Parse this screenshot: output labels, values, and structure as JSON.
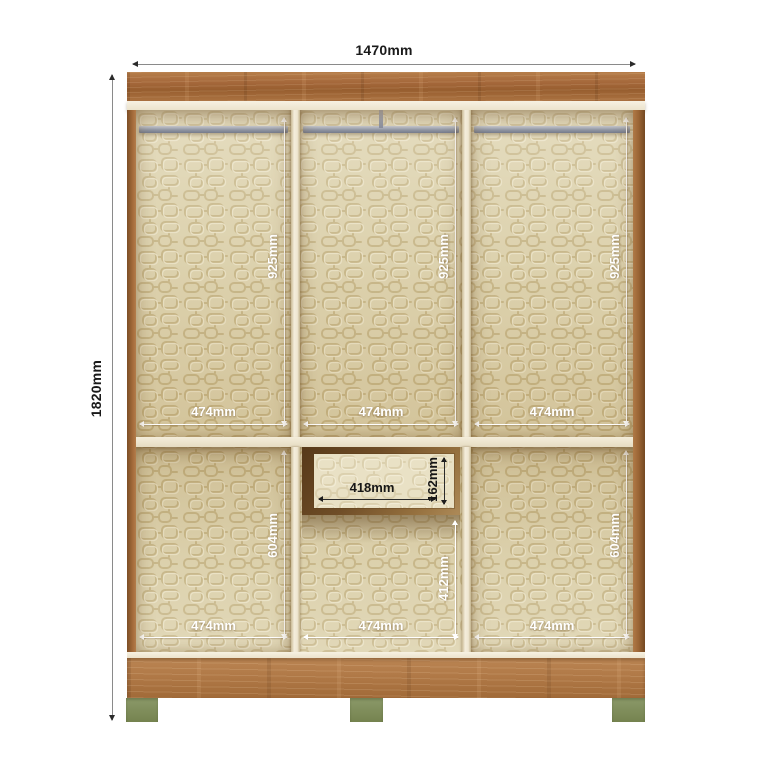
{
  "wardrobe": {
    "overall": {
      "width": "1470mm",
      "height": "1820mm"
    },
    "upper_sections": [
      {
        "width": "474mm",
        "height": "925mm"
      },
      {
        "width": "474mm",
        "height": "925mm"
      },
      {
        "width": "474mm",
        "height": "925mm"
      }
    ],
    "lower_sections": [
      {
        "width": "474mm",
        "height": "604mm"
      },
      {
        "width": "474mm",
        "height": "412mm"
      },
      {
        "width": "474mm",
        "height": "604mm"
      }
    ],
    "drawer": {
      "width": "418mm",
      "height": "162mm"
    },
    "colors": {
      "wood": "#a9713f",
      "wood_base": "#b07a47",
      "interior_base": "#d9cda6",
      "pattern_line": "#bfab78",
      "shelf": "#f2ebd8",
      "rail": "#9298a6",
      "foot": "#7b8a5d",
      "dim_text_outside": "#1a1a1a",
      "dim_text_inside": "#ffffff"
    }
  }
}
